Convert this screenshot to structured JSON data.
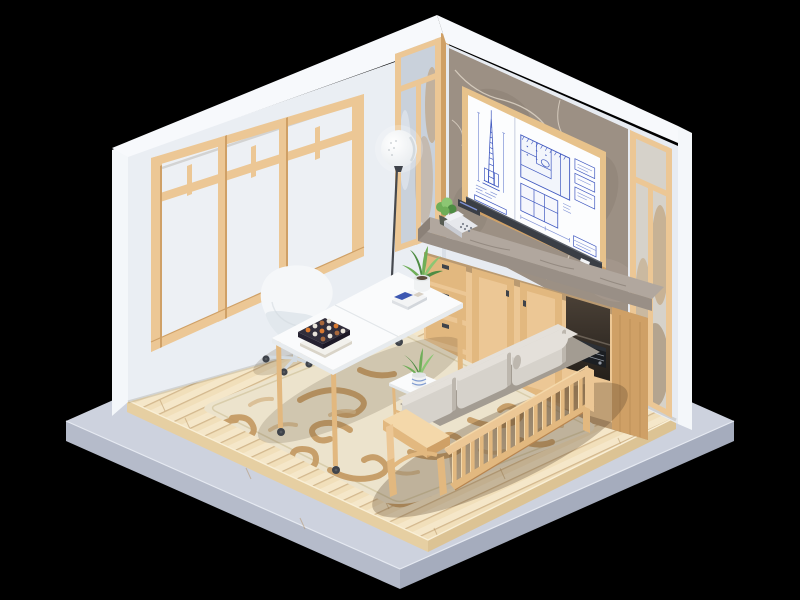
{
  "meta": {
    "type": "3d-isometric-render",
    "subject": "Low-poly isometric diorama of an architect's home office",
    "canvas_width": 800,
    "canvas_height": 600
  },
  "palette": {
    "bg": "#000000",
    "platformTop": "#cdd2de",
    "platformLeft": "#b5bbca",
    "platformRight": "#a5acbd",
    "platformEdge": "#e6eaf2",
    "floorWood": "#f1dfba",
    "floorEdgeL": "#e6cfa2",
    "floorEdgeR": "#dcc394",
    "plankLine": "rgba(176,138,88,0.45)",
    "plankLight": "rgba(255,250,235,0.30)",
    "floorHighlight": "#f9efd6",
    "wallFace": "#eaeef3",
    "wallFaceR": "#e7ebf1",
    "wallEdge": "#f4f7fa",
    "wallBand": "#f7f9fc",
    "wallShadow": "#d9dfe7",
    "wood": "#ecc795",
    "woodMid": "#e2b87f",
    "woodDark": "#cfa066",
    "woodDeep": "#b8854f",
    "woodPale": "#f4d8aa",
    "glass": "#edf0f4",
    "glassBright": "#f4f7f9",
    "frostBlue": "#c9d1db",
    "frostWarm": "#d6d2ca",
    "frostTan": "rgba(187,152,106,0.55)",
    "frostDark": "rgba(146,117,84,0.5)",
    "marble": "#9c9084",
    "marbleLight": "#b3a79a",
    "marbleDark": "#776b5f",
    "marbleVein": "rgba(226,216,202,0.8)",
    "counterTop": "#b1a79e",
    "counterFace": "#998f86",
    "counterEnd": "#8b8178",
    "boardWhite": "#fcfdfe",
    "boardFrame": "#e7c28b",
    "ink": "#4059c0",
    "inkSoft": "#8193d6",
    "tray": "#3a3e45",
    "trayHi": "#5a5f68",
    "deskTop": "#fafbfc",
    "deskEdge": "#e7ebee",
    "deskSeam": "#e2e6ea",
    "chairWhite": "#f5f7f9",
    "chairShade": "#e2e8ed",
    "chairDeep": "#d3dae0",
    "cushion": "#d6d2cb",
    "cushionTop": "#e4e0da",
    "cushionShade": "#bdb7ae",
    "cushionDeep": "#a39c92",
    "rugBase": "#ece3cc",
    "rugBorder": "#d9cdab",
    "rugSwirl": "#c49a62",
    "rugSwirlLight": "#d8ba8e",
    "potWhite": "#f0f2f3",
    "potBlue": "#7f9bd1",
    "leaf": "#6fae58",
    "leafLight": "#8cc673",
    "leafDark": "#4e8c43",
    "bookDark": "#322e3b",
    "bookSideA": "#262231",
    "bookSideB": "#1d1926",
    "bookOrange": "#d97a31",
    "bookCream": "#e9e4da",
    "bookTan": "#a8683c",
    "pageWhite": "#f2f1ec",
    "pageShade": "#d9d4c8",
    "stereo": "#1b1e22",
    "stereoTopF": "#2c3036",
    "stereoLine": "#9298a2",
    "phone": "#e6e8ec",
    "phoneShade": "#c9ccd3",
    "phoneKeys": "#7c828c",
    "metal": "#3f434a",
    "casterDot": "#55595f",
    "cavityTop": "#4a4036",
    "cavityBottom": "#241f1a",
    "shadow": "rgba(85,65,42,0.30)",
    "shadowSoft": "rgba(85,65,42,0.18)",
    "toeShadow": "rgba(70,50,30,0.30)",
    "baseLine": "rgba(90,75,55,0.28)",
    "lampPole": "#45484e",
    "lampShadeEdge": "#e7ebee",
    "lampGlow": "#ffffff"
  },
  "objects": [
    {
      "name": "backdrop",
      "desc": "black void background"
    },
    {
      "name": "platform-base",
      "desc": "pale blue-gray concrete display slab"
    },
    {
      "name": "wood-floor",
      "desc": "light plank wood floor on raised plinth"
    },
    {
      "name": "area-rug",
      "desc": "cream rug with tan scroll / swirl pattern"
    },
    {
      "name": "left-wall",
      "desc": "white wall filled with wood-framed frosted windows and transom panes"
    },
    {
      "name": "frosted-panel-left",
      "desc": "narrow wood-framed frosted glass panel beside the corner"
    },
    {
      "name": "right-wall",
      "desc": "feature wall: gray-brown marble slab flanked by frosted panels"
    },
    {
      "name": "blueprint-board",
      "desc": "wood-framed whiteboard with skyscraper elevation and floor-plan blueprints in blue ink"
    },
    {
      "name": "board-tray",
      "desc": "dark marker tray under the board with a white marker"
    },
    {
      "name": "frosted-panel-right",
      "desc": "tall frosted glass panel at right edge of marble wall"
    },
    {
      "name": "sideboard",
      "desc": "light-wood cabinet run: four drawers, two shaker doors, open hi-fi shelf, end panel"
    },
    {
      "name": "counter",
      "desc": "gray marble countertop on the sideboard"
    },
    {
      "name": "telephone",
      "desc": "gray desk telephone on the counter"
    },
    {
      "name": "counter-plant",
      "desc": "small leafy plant in dark pot"
    },
    {
      "name": "document-tray",
      "desc": "dark tray with rolled drawings"
    },
    {
      "name": "stereo-receiver",
      "desc": "black hi-fi unit in the open shelf"
    },
    {
      "name": "floor-lamp",
      "desc": "white globe floor lamp on thin dark stem"
    },
    {
      "name": "desk",
      "desc": "white-top work desk, wooden legs on casters"
    },
    {
      "name": "desk-books",
      "desc": "stack of books, patterned dark cover"
    },
    {
      "name": "desk-notebooks",
      "desc": "white notebook with blue booklet"
    },
    {
      "name": "desk-plant",
      "desc": "aloe in white pot"
    },
    {
      "name": "office-chair",
      "desc": "white shell swivel chair on casters"
    },
    {
      "name": "side-table",
      "desc": "white-top wooden side table with potted aloe"
    },
    {
      "name": "sofa",
      "desc": "mission-style wood bench sofa, vertical slats, gray cushions and bolster"
    }
  ]
}
